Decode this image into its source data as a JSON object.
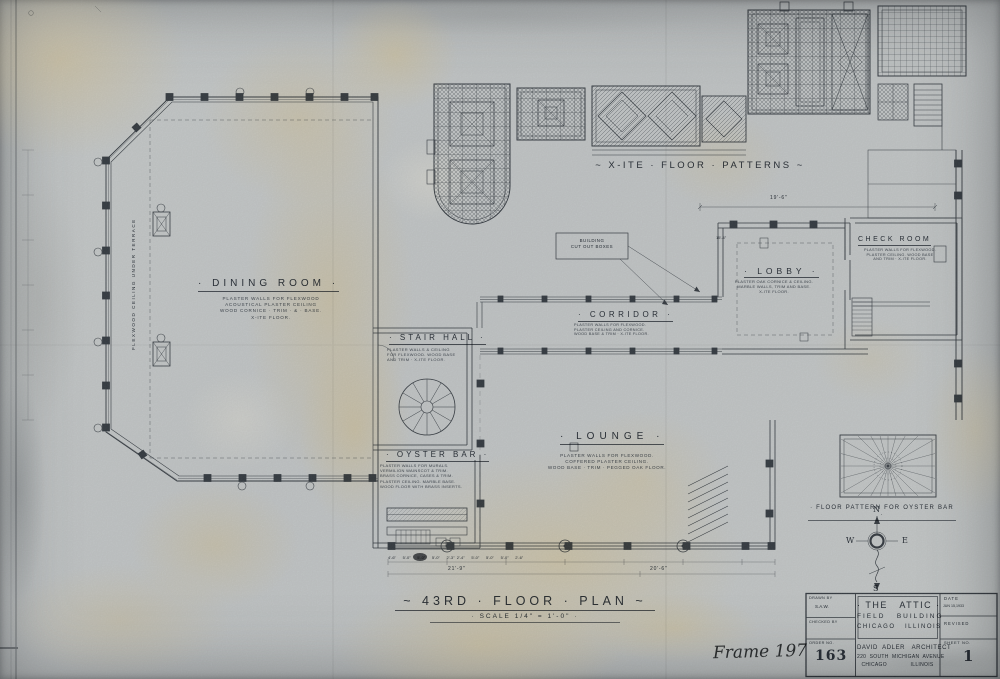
{
  "titles": {
    "patterns_title": "~  X-ITE · FLOOR · PATTERNS  ~",
    "plan_title": "~  43RD · FLOOR · PLAN  ~",
    "plan_scale": "· SCALE   1/4\" = 1'-0\" ·",
    "oyster_pattern_caption": "· FLOOR PATTERN FOR OYSTER BAR ·"
  },
  "rooms": {
    "dining": {
      "name": "· DINING   ROOM ·",
      "notes": "PLASTER WALLS FOR FLEXWOOD\nACOUSTICAL PLASTER CEILING\nWOOD CORNICE · TRIM · & · BASE.\nX-ITE FLOOR."
    },
    "stair_hall": {
      "name": "· STAIR  HALL ·",
      "notes": "PLASTER WALLS & CEILING\nFOR FLEXWOOD. WOOD BASE\nAND TRIM · X-ITE FLOOR."
    },
    "oyster_bar": {
      "name": "· OYSTER  BAR ·",
      "notes": "PLASTER WALLS FOR MURALS.\nVERMILION WAINSCOT & TRIM.\nBRASS CORNICE, CASES & TRIM.\nPLASTER CEILING. MARBLE BASE.\nWOOD FLOOR WITH BRASS INSERTS."
    },
    "lounge": {
      "name": "· LOUNGE ·",
      "notes": "PLASTER WALLS FOR FLEXWOOD.\nCOFFERED PLASTER CEILING.\nWOOD BASE · TRIM · PEGGED OAK FLOOR."
    },
    "corridor": {
      "name": "· CORRIDOR ·",
      "notes": "PLASTER WALLS FOR FLEXWOOD.\nPLASTER CEILING AND CORNICE.\nWOOD BASE & TRIM · X-ITE FLOOR."
    },
    "lobby": {
      "name": "· LOBBY ·",
      "notes": "PLASTER OAK CORNICE & CEILING.\nMARBLE WALLS, TRIM AND BASE.\nX-ITE FLOOR."
    },
    "check_room": {
      "name": "CHECK ROOM",
      "notes": "PLASTER WALLS FOR FLEXWOOD.\nPLASTER CEILING. WOOD BASE\nAND TRIM · X-ITE FLOOR."
    }
  },
  "annotations": {
    "building_note": "BUILDING\nCUT OUT BOXES",
    "terrace_note": "FLEXWOOD CEILING UNDER TERRACE",
    "frame_label": "Frame 197"
  },
  "dimensions": {
    "lobby_width": "19'-6\"",
    "lobby_sub": "15'-4\"",
    "window_row": "4'-6\"      5'-0\"      5'-0\"      5'-0\"      2'-3\"  2'-4\"      5'-0\"      5'-0\"      5'-0\"      2'-6\"",
    "total_left": "21'-9\"",
    "total_right": "20'-6\""
  },
  "compass": {
    "north": "N",
    "south": "S",
    "east": "E",
    "west": "W"
  },
  "title_block": {
    "drawn_by_label": "DRAWN BY",
    "drawn_by_value": "S.A.W.",
    "checked_by_label": "CHECKED BY",
    "order_no_label": "ORDER NO.",
    "order_no_value": "163",
    "project_line1": "· THE   ATTIC ·",
    "project_line2": "FIELD   BUILDING",
    "project_line3": "CHICAGO   ILLINOIS",
    "architect_line1": "DAVID  ADLER   ARCHITECT",
    "architect_line2": "220  SOUTH  MICHIGAN  AVENUE",
    "architect_line3": "CHICAGO              ILLINOIS",
    "date_label": "DATE",
    "date_value": "JUN 15,1933",
    "revised_label": "REVISED",
    "sheet_no_label": "SHEET NO.",
    "sheet_no_value": "1"
  }
}
